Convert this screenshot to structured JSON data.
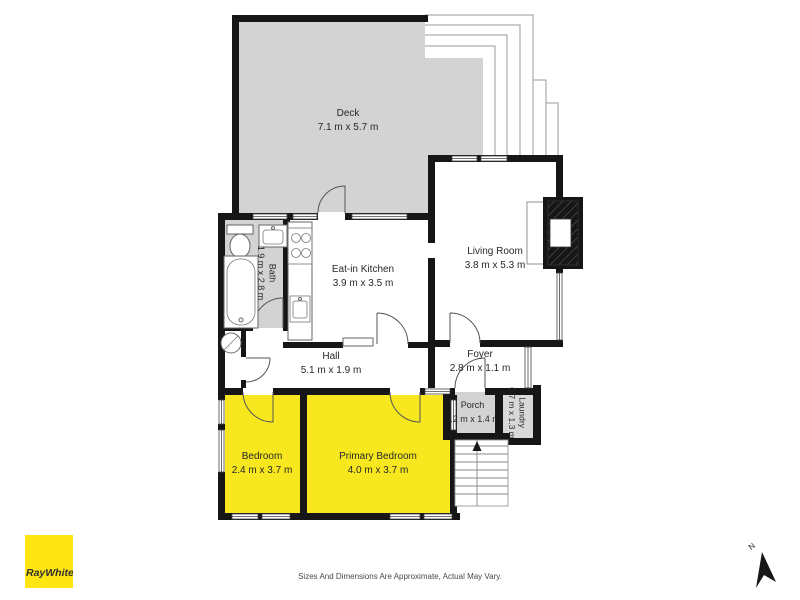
{
  "colors": {
    "wall": "#161616",
    "deck_floor": "#d3d3d3",
    "bath_floor": "#d3d3d3",
    "porch_floor": "#d3d3d3",
    "laundry_floor": "#d8d8d8",
    "bedroom_floor": "#f7e71f",
    "logo_yellow": "#ffe512"
  },
  "rooms": {
    "deck": {
      "name": "Deck",
      "dims": "7.1 m x 5.7 m"
    },
    "eat_in_kitchen": {
      "name": "Eat-in Kitchen",
      "dims": "3.9 m x 3.5 m"
    },
    "living_room": {
      "name": "Living Room",
      "dims": "3.8 m x 5.3 m"
    },
    "bath": {
      "name": "Bath",
      "dims": "1.9 m x 2.8 m"
    },
    "hall": {
      "name": "Hall",
      "dims": "5.1 m x 1.9 m"
    },
    "foyer": {
      "name": "Foyer",
      "dims": "2.8 m x 1.1 m"
    },
    "porch": {
      "name": "Porch",
      "dims": "1.2 m x 1.4 m"
    },
    "laundry": {
      "name": "Laundry",
      "dims": "0.7 m x 1.3 m"
    },
    "bedroom": {
      "name": "Bedroom",
      "dims": "2.4 m x 3.7 m"
    },
    "primary_bedroom": {
      "name": "Primary Bedroom",
      "dims": "4.0 m x 3.7 m"
    }
  },
  "branding": {
    "logo_text": "RayWhite."
  },
  "compass": {
    "north_label": "N"
  },
  "footer": {
    "disclaimer": "Sizes And Dimensions Are Approximate, Actual May Vary."
  }
}
